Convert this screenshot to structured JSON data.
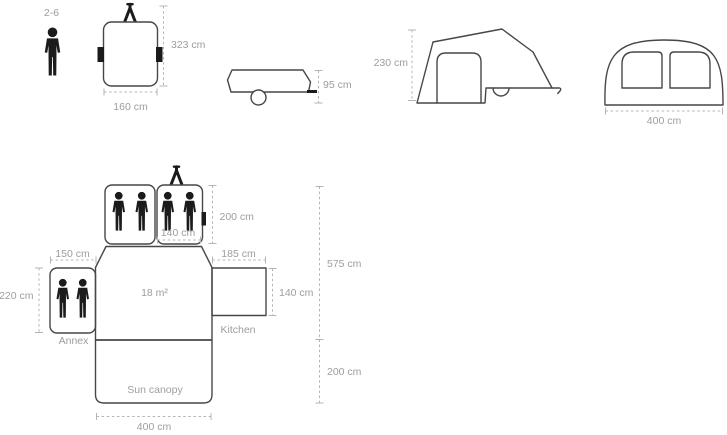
{
  "colors": {
    "outline": "#474747",
    "figure": "#1b1b1b",
    "dim": "#b4b4b4",
    "txt": "#9d9d9d"
  },
  "capacity_label": "2-6",
  "views": {
    "trailer_top": {
      "length": "323 cm",
      "width": "160 cm"
    },
    "trailer_folded_side": {
      "height": "95 cm"
    },
    "tent_side": {
      "height": "230 cm"
    },
    "tent_front": {
      "width": "400 cm"
    }
  },
  "floor_plan": {
    "bedroom_length": "200 cm",
    "bedroom_width": "140 cm",
    "annex_width": "150 cm",
    "kitchen_width": "185 cm",
    "annex_depth": "220 cm",
    "kitchen_depth": "140 cm",
    "main_length": "575 cm",
    "canopy_depth": "200 cm",
    "overall_width": "400 cm",
    "living_area": "18 m²",
    "annex_label": "Annex",
    "kitchen_label": "Kitchen",
    "canopy_label": "Sun canopy"
  }
}
